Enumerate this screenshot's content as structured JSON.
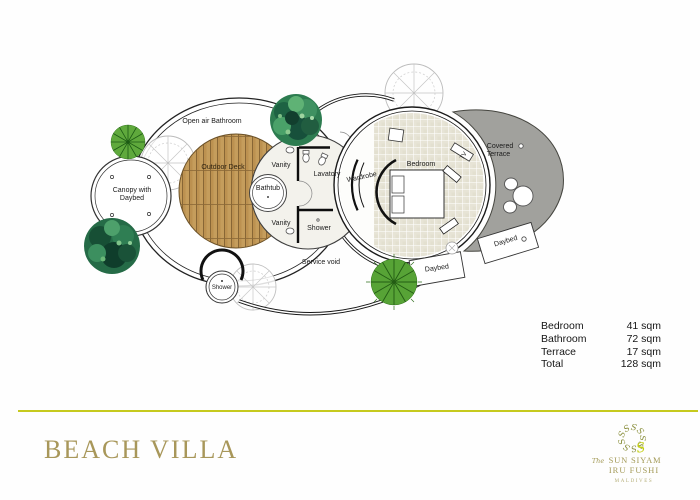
{
  "plan": {
    "labels": {
      "open_air_bathroom": "Open air Bathroom",
      "outdoor_deck": "Outdoor Deck",
      "canopy_line1": "Canopy with",
      "canopy_line2": "Daybed",
      "bathtub": "Bathtub",
      "vanity_top": "Vanity",
      "vanity_bottom": "Vanity",
      "lavatory": "Lavatory",
      "shower": "Shower",
      "service_void": "Service void",
      "shower_outdoor": "Shower",
      "wardrobe": "Wardrobe",
      "bedroom": "Bedroom",
      "tv": "TV",
      "covered_terrace_line1": "Covered",
      "covered_terrace_line2": "Terrace",
      "daybed_terrace": "Daybed",
      "daybed_garden": "Daybed"
    }
  },
  "areas": {
    "rows": [
      {
        "label": "Bedroom",
        "value": "41 sqm"
      },
      {
        "label": "Bathroom",
        "value": "72 sqm"
      },
      {
        "label": "Terrace",
        "value": "17 sqm"
      },
      {
        "label": "Total",
        "value": "128 sqm"
      }
    ]
  },
  "footer": {
    "title": "BEACH VILLA",
    "brand_prefix": "The",
    "brand_name": "SUN SIYAM",
    "brand_resort": "IRU FUSHI",
    "brand_country": "MALDIVES"
  },
  "colors": {
    "accent_line": "#c6ca1e",
    "title_gold": "#a8975a",
    "terrace_gray": "#a1a19d",
    "deck_wood": "#c59d5c",
    "tile": "#e7e4d6",
    "tree_green": "#5fa93c",
    "bush_green": "#2d7c50",
    "logo_olive": "#8c9140",
    "logo_lime": "#c3cf10"
  }
}
